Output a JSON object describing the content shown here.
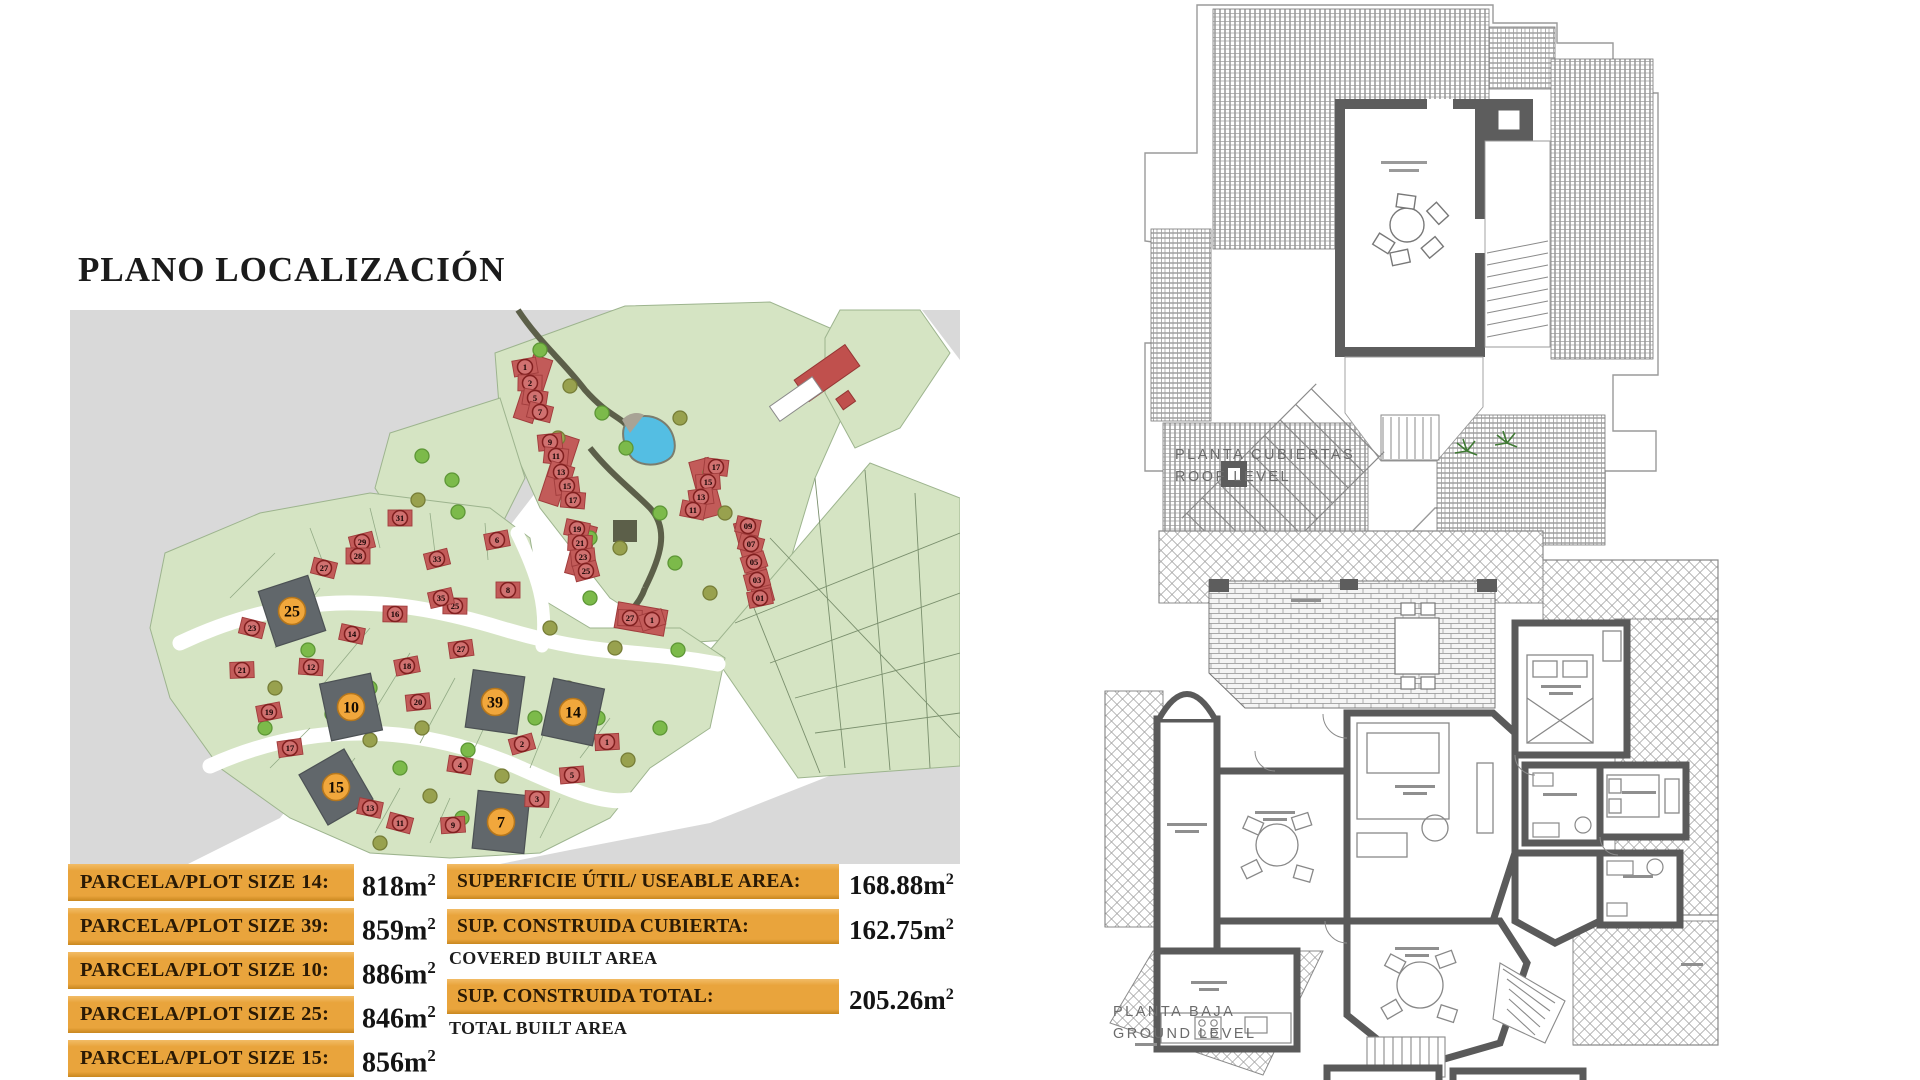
{
  "page_title": "PLANO LOCALIZACIÓN",
  "left_panel": {
    "plot_table": {
      "rows": [
        {
          "label": "PARCELA/PLOT SIZE 14:",
          "value": "818",
          "unit_base": "m",
          "unit_sup": "2"
        },
        {
          "label": "PARCELA/PLOT SIZE 39:",
          "value": "859",
          "unit_base": "m",
          "unit_sup": "2"
        },
        {
          "label": "PARCELA/PLOT SIZE 10:",
          "value": "886",
          "unit_base": "m",
          "unit_sup": "2"
        },
        {
          "label": "PARCELA/PLOT SIZE 25:",
          "value": "846",
          "unit_base": "m",
          "unit_sup": "2"
        },
        {
          "label": "PARCELA/PLOT SIZE 15:",
          "value": "856",
          "unit_base": "m",
          "unit_sup": "2"
        }
      ]
    },
    "area_table": {
      "rows": [
        {
          "label": "SUPERFICIE ÚTIL/ USEABLE AREA:",
          "sublabel": "",
          "value": "168.88",
          "unit_base": "m",
          "unit_sup": "2"
        },
        {
          "label": "SUP. CONSTRUIDA CUBIERTA:",
          "sublabel": "COVERED BUILT AREA",
          "value": "162.75",
          "unit_base": "m",
          "unit_sup": "2"
        },
        {
          "label": "SUP. CONSTRUIDA TOTAL:",
          "sublabel": "TOTAL BUILT AREA",
          "value": "205.26",
          "unit_base": "m",
          "unit_sup": "2"
        }
      ]
    },
    "map": {
      "colors": {
        "gray": "#d9d9d9",
        "green": "#d5e4c3",
        "green_stroke": "#9db48e",
        "tree_a": "#7cba4a",
        "tree_a_stroke": "#5d9636",
        "tree_b": "#98a14e",
        "tree_b_stroke": "#767d37",
        "house": "#c25b59",
        "house_stroke": "#a03c3c",
        "badge_fill": "#d07170",
        "badge_stroke": "#811f1f",
        "plot_dark": "#61676b",
        "plot_dark_stroke": "#4c5154",
        "highlight": "#f1a73c",
        "highlight_stroke": "#b5761c",
        "pond": "#54bee3",
        "path_dark": "#5c5f49"
      },
      "highlighted_plots": [
        {
          "n": "25",
          "x": 222,
          "y": 313,
          "rot": -18
        },
        {
          "n": "10",
          "x": 281,
          "y": 409,
          "rot": -12
        },
        {
          "n": "39",
          "x": 425,
          "y": 404,
          "rot": 8
        },
        {
          "n": "14",
          "x": 503,
          "y": 414,
          "rot": 12
        },
        {
          "n": "15",
          "x": 266,
          "y": 489,
          "rot": -30
        },
        {
          "n": "7",
          "x": 431,
          "y": 524,
          "rot": 6
        }
      ],
      "numbered_plots": [
        {
          "n": "31",
          "x": 330,
          "y": 220
        },
        {
          "n": "29",
          "x": 292,
          "y": 244
        },
        {
          "n": "27",
          "x": 254,
          "y": 270
        },
        {
          "n": "28",
          "x": 288,
          "y": 258
        },
        {
          "n": "33",
          "x": 367,
          "y": 261
        },
        {
          "n": "23",
          "x": 182,
          "y": 330
        },
        {
          "n": "21",
          "x": 172,
          "y": 372
        },
        {
          "n": "19",
          "x": 199,
          "y": 414
        },
        {
          "n": "17",
          "x": 220,
          "y": 450
        },
        {
          "n": "16",
          "x": 325,
          "y": 316
        },
        {
          "n": "14",
          "x": 282,
          "y": 336
        },
        {
          "n": "12",
          "x": 241,
          "y": 369
        },
        {
          "n": "25",
          "x": 385,
          "y": 308
        },
        {
          "n": "27",
          "x": 391,
          "y": 351
        },
        {
          "n": "18",
          "x": 337,
          "y": 368
        },
        {
          "n": "20",
          "x": 348,
          "y": 404
        },
        {
          "n": "35",
          "x": 371,
          "y": 300
        },
        {
          "n": "8",
          "x": 438,
          "y": 292
        },
        {
          "n": "6",
          "x": 427,
          "y": 242
        },
        {
          "n": "13",
          "x": 300,
          "y": 510
        },
        {
          "n": "11",
          "x": 330,
          "y": 525
        },
        {
          "n": "9",
          "x": 383,
          "y": 527
        },
        {
          "n": "2",
          "x": 452,
          "y": 446
        },
        {
          "n": "4",
          "x": 390,
          "y": 467
        },
        {
          "n": "3",
          "x": 467,
          "y": 501
        },
        {
          "n": "5",
          "x": 502,
          "y": 477
        },
        {
          "n": "1",
          "x": 537,
          "y": 444
        },
        {
          "n": "1",
          "x": 455,
          "y": 69
        },
        {
          "n": "2",
          "x": 460,
          "y": 85
        },
        {
          "n": "5",
          "x": 465,
          "y": 100
        },
        {
          "n": "7",
          "x": 470,
          "y": 114
        },
        {
          "n": "9",
          "x": 480,
          "y": 144
        },
        {
          "n": "11",
          "x": 486,
          "y": 158
        },
        {
          "n": "13",
          "x": 491,
          "y": 174
        },
        {
          "n": "15",
          "x": 497,
          "y": 188
        },
        {
          "n": "17",
          "x": 503,
          "y": 202
        },
        {
          "n": "17",
          "x": 646,
          "y": 169
        },
        {
          "n": "15",
          "x": 638,
          "y": 184
        },
        {
          "n": "13",
          "x": 631,
          "y": 199
        },
        {
          "n": "11",
          "x": 623,
          "y": 212
        },
        {
          "n": "19",
          "x": 507,
          "y": 231
        },
        {
          "n": "21",
          "x": 510,
          "y": 245
        },
        {
          "n": "23",
          "x": 513,
          "y": 259
        },
        {
          "n": "25",
          "x": 516,
          "y": 273
        },
        {
          "n": "09",
          "x": 678,
          "y": 228
        },
        {
          "n": "07",
          "x": 681,
          "y": 246
        },
        {
          "n": "05",
          "x": 684,
          "y": 264
        },
        {
          "n": "03",
          "x": 687,
          "y": 282
        },
        {
          "n": "01",
          "x": 690,
          "y": 300
        },
        {
          "n": "27",
          "x": 560,
          "y": 320
        },
        {
          "n": "1",
          "x": 582,
          "y": 322
        }
      ],
      "row_houses": [
        {
          "x": 463,
          "y": 91,
          "w": 20,
          "h": 66,
          "rot": 18
        },
        {
          "x": 489,
          "y": 172,
          "w": 20,
          "h": 70,
          "rot": 18
        },
        {
          "x": 636,
          "y": 190,
          "w": 20,
          "h": 58,
          "rot": -15
        },
        {
          "x": 511,
          "y": 252,
          "w": 20,
          "h": 52,
          "rot": 15
        },
        {
          "x": 684,
          "y": 264,
          "w": 20,
          "h": 84,
          "rot": -15
        },
        {
          "x": 571,
          "y": 321,
          "w": 50,
          "h": 26,
          "rot": 10
        }
      ],
      "trees": [
        {
          "x": 470,
          "y": 52,
          "t": "a"
        },
        {
          "x": 500,
          "y": 88,
          "t": "b"
        },
        {
          "x": 532,
          "y": 115,
          "t": "a"
        },
        {
          "x": 488,
          "y": 140,
          "t": "b"
        },
        {
          "x": 556,
          "y": 150,
          "t": "a"
        },
        {
          "x": 610,
          "y": 120,
          "t": "b"
        },
        {
          "x": 640,
          "y": 175,
          "t": "a"
        },
        {
          "x": 655,
          "y": 215,
          "t": "b"
        },
        {
          "x": 590,
          "y": 215,
          "t": "a"
        },
        {
          "x": 550,
          "y": 250,
          "t": "b"
        },
        {
          "x": 605,
          "y": 265,
          "t": "a"
        },
        {
          "x": 640,
          "y": 295,
          "t": "b"
        },
        {
          "x": 520,
          "y": 300,
          "t": "a"
        },
        {
          "x": 352,
          "y": 158,
          "t": "a"
        },
        {
          "x": 382,
          "y": 182,
          "t": "a"
        },
        {
          "x": 348,
          "y": 202,
          "t": "b"
        },
        {
          "x": 388,
          "y": 214,
          "t": "a"
        },
        {
          "x": 208,
          "y": 300,
          "t": "b"
        },
        {
          "x": 238,
          "y": 352,
          "t": "a"
        },
        {
          "x": 205,
          "y": 390,
          "t": "b"
        },
        {
          "x": 262,
          "y": 416,
          "t": "a"
        },
        {
          "x": 300,
          "y": 442,
          "t": "b"
        },
        {
          "x": 330,
          "y": 470,
          "t": "a"
        },
        {
          "x": 360,
          "y": 498,
          "t": "b"
        },
        {
          "x": 392,
          "y": 520,
          "t": "a"
        },
        {
          "x": 428,
          "y": 540,
          "t": "b"
        },
        {
          "x": 300,
          "y": 390,
          "t": "a"
        },
        {
          "x": 352,
          "y": 430,
          "t": "b"
        },
        {
          "x": 398,
          "y": 452,
          "t": "a"
        },
        {
          "x": 432,
          "y": 478,
          "t": "b"
        },
        {
          "x": 465,
          "y": 420,
          "t": "a"
        },
        {
          "x": 498,
          "y": 390,
          "t": "b"
        },
        {
          "x": 528,
          "y": 420,
          "t": "a"
        },
        {
          "x": 558,
          "y": 462,
          "t": "b"
        },
        {
          "x": 590,
          "y": 430,
          "t": "a"
        },
        {
          "x": 545,
          "y": 350,
          "t": "b"
        },
        {
          "x": 520,
          "y": 240,
          "t": "a"
        },
        {
          "x": 480,
          "y": 330,
          "t": "b"
        },
        {
          "x": 608,
          "y": 352,
          "t": "a"
        },
        {
          "x": 195,
          "y": 430,
          "t": "a"
        },
        {
          "x": 310,
          "y": 545,
          "t": "b"
        }
      ]
    }
  },
  "right_panel": {
    "roof_plan_label_1": "PLANTA CUBIERTAS",
    "roof_plan_label_2": "ROOF LEVEL",
    "ground_plan_label_1": "PLANTA BAJA",
    "ground_plan_label_2": "GROUND LEVEL"
  }
}
